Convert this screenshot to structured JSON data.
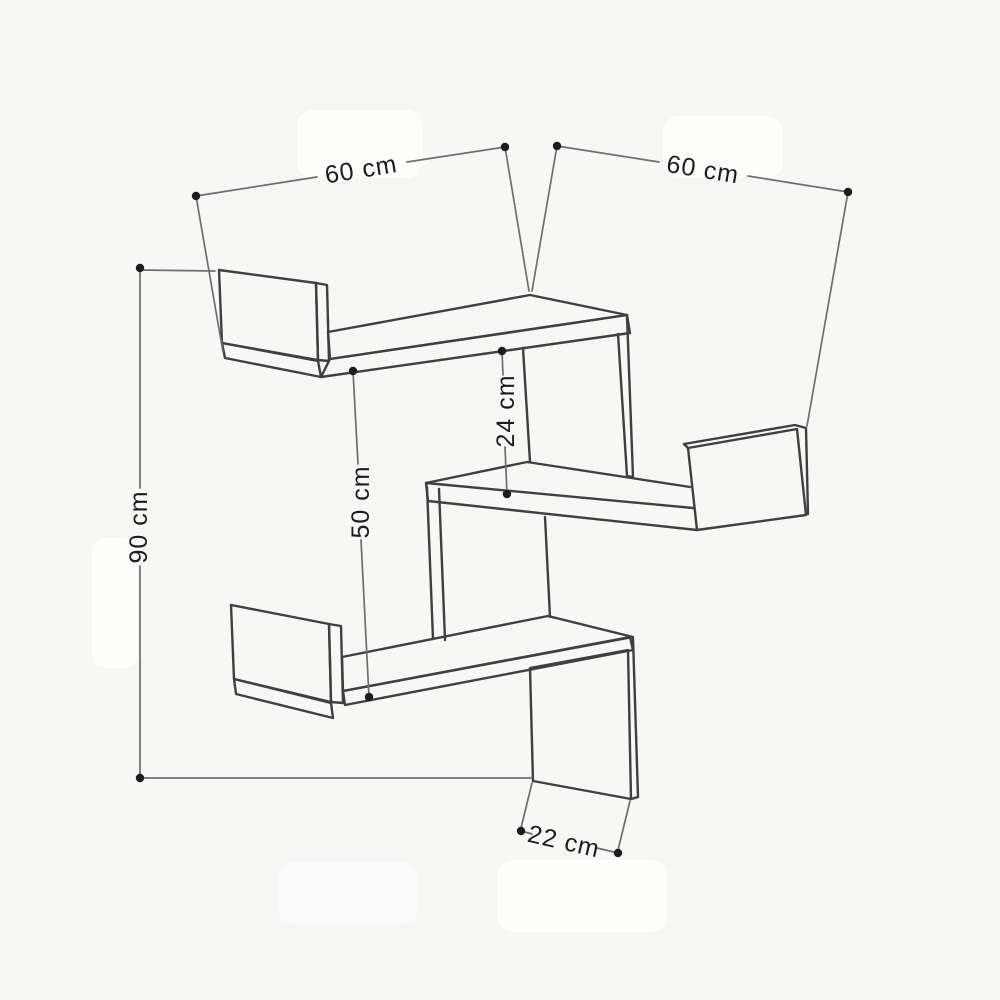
{
  "diagram": {
    "title": "Corner zigzag wall shelf dimension drawing",
    "unit": "cm",
    "dimensions": [
      {
        "id": "width-left-wing",
        "label": "60 cm",
        "value": 60
      },
      {
        "id": "width-right-wing",
        "label": "60 cm",
        "value": 60
      },
      {
        "id": "height-total",
        "label": "90 cm",
        "value": 90
      },
      {
        "id": "gap-upper-shelves",
        "label": "24 cm",
        "value": 24
      },
      {
        "id": "gap-lower-shelves",
        "label": "50 cm",
        "value": 50
      },
      {
        "id": "shelf-depth",
        "label": "22 cm",
        "value": 22
      }
    ],
    "colors": {
      "background": "#f7f7f6",
      "outline": "#3f3f3f",
      "dimension_line": "#6e6e6e",
      "marker": "#1c1c1c",
      "text": "#1c1c1c"
    }
  }
}
